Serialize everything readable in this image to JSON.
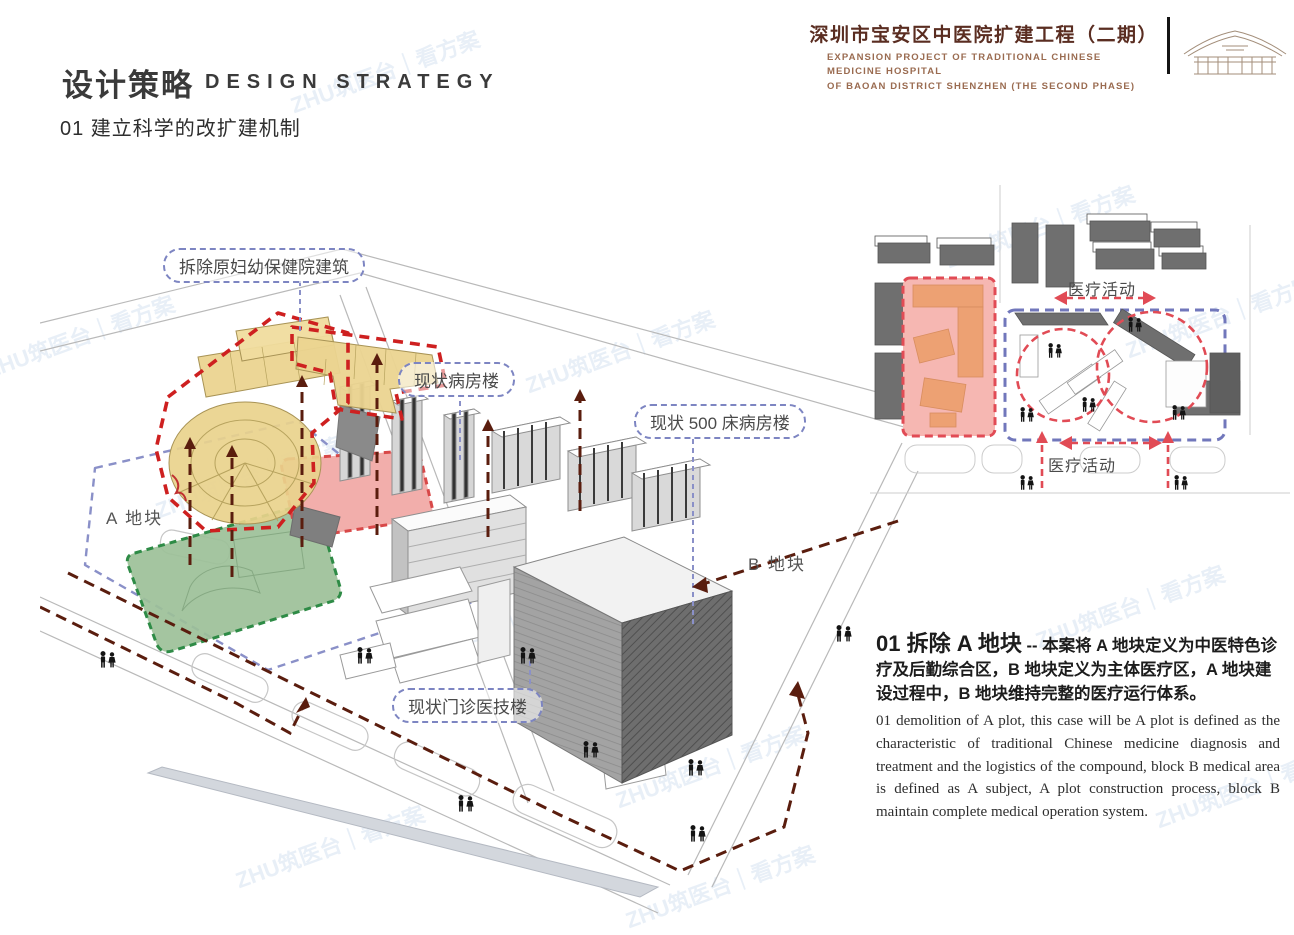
{
  "header": {
    "project_title_cn": "深圳市宝安区中医院扩建工程（二期）",
    "project_title_en_line1": "EXPANSION PROJECT OF TRADITIONAL CHINESE MEDICINE HOSPITAL",
    "project_title_en_line2": "OF BAOAN DISTRICT SHENZHEN (THE SECOND PHASE)",
    "logo_icon": "roof-truss-logo"
  },
  "section": {
    "title_cn": "设计策略",
    "title_en": "DESIGN STRATEGY",
    "subtitle": "01 建立科学的改扩建机制"
  },
  "site_diagram": {
    "labels": {
      "demolish": "拆除原妇幼保健院建筑",
      "existing_ward": "现状病房楼",
      "existing_500bed": "现状 500 床病房楼",
      "existing_clinic": "现状门诊医技楼",
      "plot_a": "A 地块",
      "plot_b": "B 地块"
    },
    "colors": {
      "demolish_outline_red": "#ce2020",
      "building_yellow": "#ebd490",
      "plot_green": "#9cc098",
      "plot_pink": "#f2aeab",
      "boundary_blue": "#8a90c8",
      "route_maroon": "#5a1d0e",
      "building_gray": "#d6d6d6"
    }
  },
  "mini_diagram": {
    "label_medical_activity_top": "医疗活动",
    "label_medical_activity_bottom": "医疗活动",
    "colors": {
      "zone_pink": "#f6b7b2",
      "zone_orange": "#eda173",
      "flow_red": "#e14b55",
      "boundary_blue": "#7177bb"
    }
  },
  "description": {
    "heading_big": "01 拆除 A 地块",
    "heading_dash": " -- ",
    "heading_rest": "本案将 A 地块定义为中医特色诊疗及后勤综合区，B 地块定义为主体医疗区，A 地块建设过程中，B 地块维持完整的医疗运行体系。",
    "body_en": "01 demolition of A plot, this case will be A plot is defined as the characteristic of traditional Chinese medicine diagnosis and treatment and the logistics of the compound, block B medical area is defined as A subject, A plot construction process, block B maintain complete medical operation system."
  },
  "watermark": {
    "text": "ZHU筑医台｜看方案"
  }
}
